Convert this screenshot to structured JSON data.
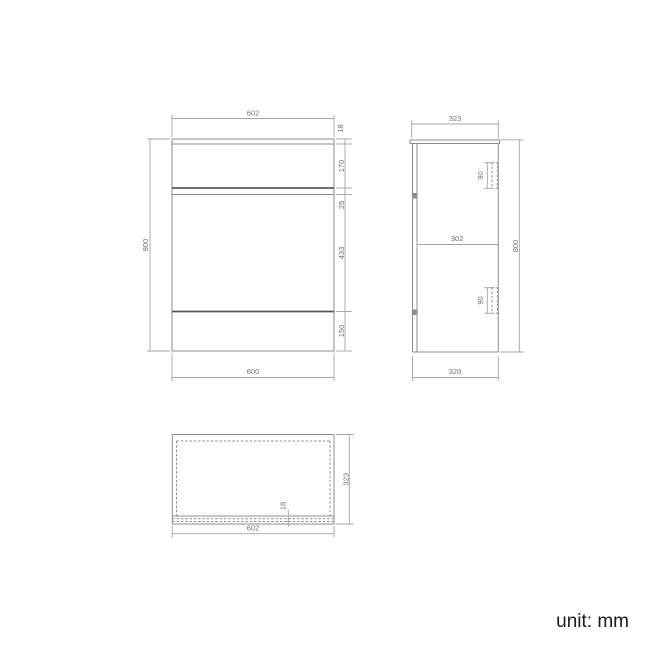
{
  "drawing": {
    "front_view": {
      "width_top": "602",
      "thickness_top": "18",
      "drawer_height": "170",
      "gap_height": "25",
      "door_height": "433",
      "plinth_height": "150",
      "overall_height": "800",
      "width_bottom": "600"
    },
    "side_view": {
      "depth_top": "323",
      "handle_upper": "90",
      "internal_depth": "302",
      "handle_lower": "90",
      "overall_height": "800",
      "depth_bottom": "320"
    },
    "top_view": {
      "depth": "323",
      "panel_thickness": "18",
      "width": "602"
    },
    "unit_label": "unit: mm",
    "colors": {
      "outline": "#8c8c8c",
      "outline_dark": "#5a5a5a",
      "dimension_line": "#a3a3a3",
      "dimension_text": "#707070",
      "unit_text": "#1a1a1a",
      "background": "#ffffff"
    }
  }
}
